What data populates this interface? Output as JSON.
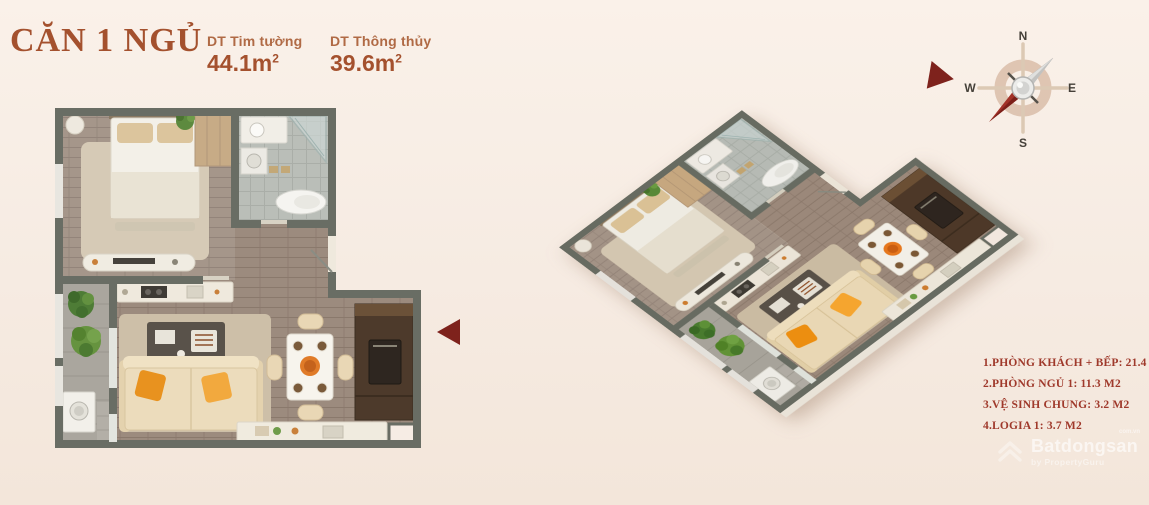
{
  "title_block": {
    "title": "CĂN 1 NGỦ",
    "metrics": [
      {
        "label": "DT Tim tường",
        "value": "44.1m",
        "sup": "2"
      },
      {
        "label": "DT Thông thủy",
        "value": "39.6m",
        "sup": "2"
      }
    ]
  },
  "legend": {
    "items": [
      "1.PHÒNG KHÁCH + BẾP: 21.4 M2",
      "2.PHÒNG NGỦ 1: 11.3 M2",
      "3.VỆ SINH CHUNG: 3.2 M2",
      "4.LOGIA 1: 3.7 M2"
    ]
  },
  "compass": {
    "north": "N",
    "south": "S",
    "east": "E",
    "west": "W"
  },
  "watermark": {
    "brand": "Batdongsan",
    "domain": "com.vn",
    "tagline": "by PropertyGuru"
  },
  "plans": {
    "left": "2D top-down floor plan of 1-bedroom apartment",
    "right": "3D isometric floor plan of same apartment"
  },
  "colors": {
    "background": "#f6ece4",
    "accent_rust": "#a4512e",
    "legend_red": "#9f392b",
    "arrow_maroon": "#7e221c",
    "wall_gray": "#696d64",
    "wood_floor": "#9c8b7e",
    "sofa_pillow_orange": "#e8921f"
  }
}
